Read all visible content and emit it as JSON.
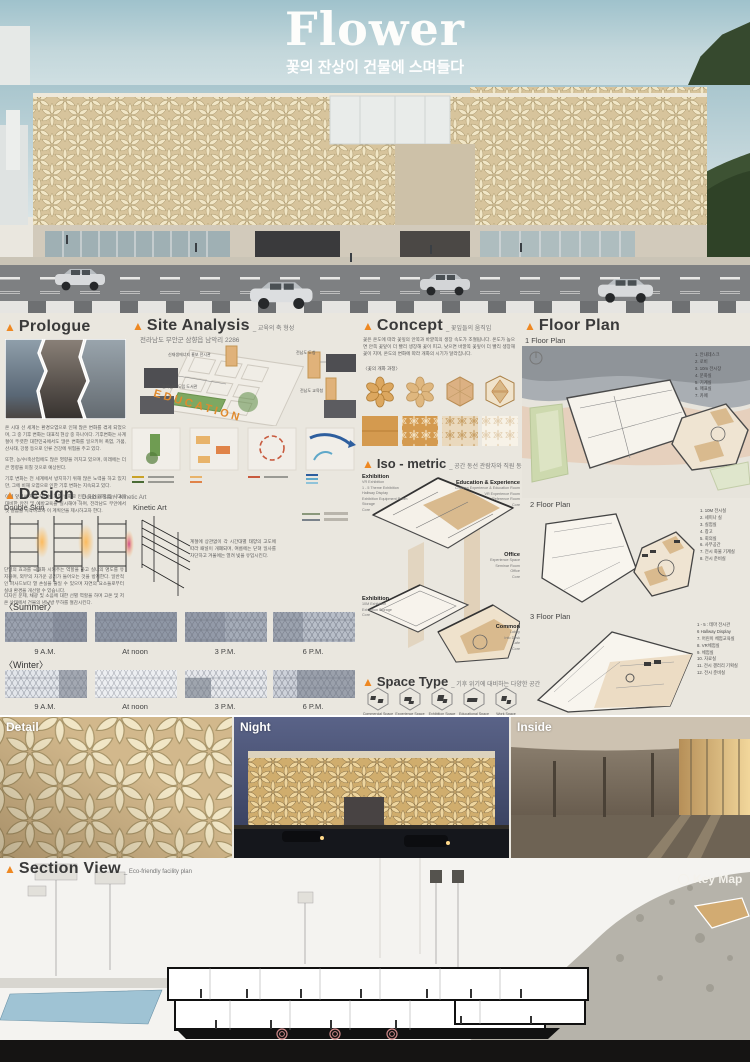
{
  "header": {
    "title": "Flower",
    "subtitle": "꽃의 잔상이 건물에 스며들다"
  },
  "prologue": {
    "heading": "Prologue",
    "paragraphs": [
      "온 시대 선 세계는 환경오염으로 인해 많은 변화를 겪게 되었으며, 그 중 기후 변화는 대표적 현상 중 하나이다. 기후변화는 사계절이 뚜렷한 대한민국에서도 많은 변화를 일으키며 폭염, 가뭄, 산사태, 강풍 등으로 인류 건강에 위협을 주고 있다.",
      "또한, 농/수/축산업에도 많은 영향을 끼치고 있으며, 미래에는 더 큰 영향을 미칠 것으로 예상된다.",
      "기후 변화는 전 세계에서 방지하기 위해 많은 노력을 하고 있지만, 그에 비해 오염으로 인한 기후 변화는 지속되고 있다.",
      "이에 앞서서 처음 우리는 기후 변화로 인한 자연 재해 및 사고에 대비한 안전 및 예방교육을 실시해야 하며, 전라남도 무안에서 첫 걸음을 시작하고자 이 계획안을 제시하고자 한다."
    ]
  },
  "site": {
    "heading": "Site Analysis",
    "axis": "_ 교육의 축 형성",
    "address": "전라남도 무안군 삼향읍 남악리 2286",
    "road_text": "EDUCATION",
    "labels": {
      "energy": "신재생에너지 홍보 전시관",
      "library": "전라남도 도립 도서관",
      "capitol": "전남도 도청",
      "edu_office": "전남도 교육청"
    }
  },
  "concept": {
    "heading": "Concept",
    "sub": "_ 꽃잎들의 움직임",
    "paragraph": "꽃은 온도에 따라 꽃잎의 안쪽과 바깥쪽의 생장 속도가 조절됩니다. 온도가 높으면 안쪽 꽃잎이 더 빨리 생장해 꽃이 피고, 낮으면 바깥쪽 꽃잎이 더 빨리 생장해 꽃이 지며, 온도의 변화에 따라 개화의 시기가 달라집니다.",
    "caption": "〈꽃의 개화 과정〉"
  },
  "floor_plan": {
    "heading": "Floor Plan",
    "plan1": "1 Floor Plan",
    "plan2": "2 Floor Plan",
    "plan3": "3 Floor Plan",
    "legend1": [
      "1. 안내데스크",
      "2. 로비",
      "3. 10m 전시장",
      "4. 문화실",
      "5. 기계실",
      "6. 매표실",
      "7. 카페"
    ],
    "legend2": [
      "1. 10M 전시실",
      "2. 세미나 실",
      "3. 실험실",
      "4. 창고",
      "5. 회의실",
      "6. 사무공간",
      "7. 전시 화물 기계실",
      "8. 전시 준비실"
    ],
    "legend3": [
      "1 - 5 : 테마 전시관",
      "6 Hallway Display",
      "7. 어린이 체험교육실",
      "8. VR체험실",
      "9. 체험실",
      "10. 자료실",
      "11. 전시 갤러리 기획실",
      "12. 전시 준비실"
    ]
  },
  "design": {
    "heading": "Design",
    "sub": "_ Double Skin / Kinetic Art",
    "double_skin": "Double Skin",
    "kinetic": "Kinetic Art",
    "para1": "단열의 효과를 극대화 시켜주는 역할을 하고 실내의 명도를 유지하며, 외부의 차가운 공기가 들어오는 것을 방지한다. 일반적인 파사드보다 열 손실을 줄일 수 있으며 자연의 요소들로부터 실내 환경을 개선할 수 있습니다.",
    "para2": "디자인 문제, 채광 및 소음에 대한 선별 역할을 하며 고온 및 저온 상태에서 건물의 냉난방 부하를 절감시킨다.",
    "para_mid": "계절에 상관없이 각 시간대별 태양의 고도에 따라 패널이 개폐되며, 여름에는 닫혀 일사를 차단하고 겨울에는 열려 빛을 유입시킨다.",
    "summer": "〈Summer〉",
    "winter": "〈Winter〉",
    "times": [
      "9 A.M.",
      "At noon",
      "3 P.M.",
      "6 P.M."
    ]
  },
  "iso": {
    "heading": "Iso - metric",
    "sub": "_ 공간 동선 관람자와 직원 동선 분리",
    "groups": [
      {
        "title": "Exhibition",
        "items": [
          "VR Exhibition",
          "1 - 5 Theme Exhibition",
          "Hallway Display",
          "Exhibition Equipment Room",
          "Storage",
          "Core"
        ]
      },
      {
        "title": "Education & Experience",
        "items": [
          "Children Experience & Education Room",
          "VR Experience Room",
          "Reference Room",
          "Core"
        ]
      },
      {
        "title": "Office",
        "items": [
          "Experience Space",
          "Seminar Room",
          "Office",
          "Core"
        ]
      },
      {
        "title": "Exhibition",
        "items": [
          "10M Exhibition",
          "Exhibition Storage",
          "Core"
        ]
      },
      {
        "title": "Common",
        "items": [
          "Lobby",
          "Info Desk",
          "Cafe",
          "Core"
        ]
      }
    ]
  },
  "space_type": {
    "heading": "Space Type",
    "sub": "_ 기후 위기에 대비하는 다양한 공간",
    "items": [
      "Commercial Space",
      "Experience Space",
      "Exhibition Space",
      "Educational Space",
      "Work Space"
    ]
  },
  "gallery": {
    "detail": "Detail",
    "night": "Night",
    "inside": "Inside"
  },
  "section_view": {
    "heading": "Section View",
    "sub": "_ Eco-friendly facility plan",
    "key_map": "Key Map"
  }
}
